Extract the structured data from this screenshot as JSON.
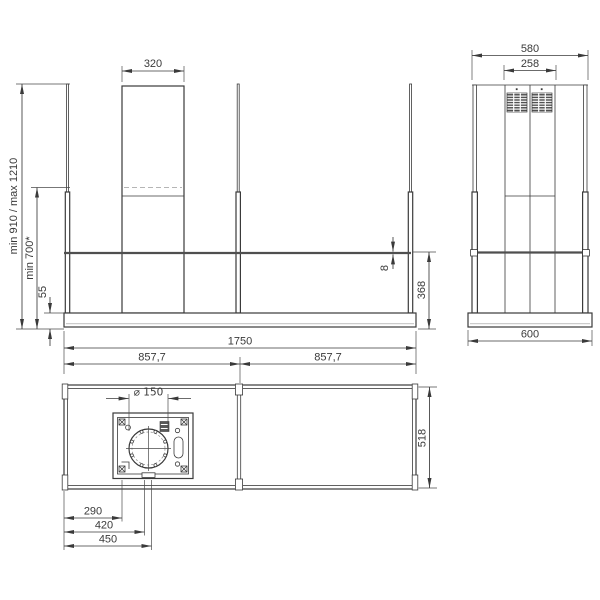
{
  "drawing": {
    "title": "island-hood-installation-drawing",
    "views": {
      "front": {
        "label": "front-elevation",
        "dims": {
          "chimney_width": "320",
          "height_range": "min 910 / max 1210",
          "min_height": "min 700*",
          "canopy_height": "55",
          "glass_thickness": "8",
          "glass_to_bottom": "368"
        }
      },
      "side": {
        "label": "side-elevation",
        "dims": {
          "total_width": "580",
          "chimney_width": "258",
          "canopy_depth": "600"
        }
      },
      "plan": {
        "label": "bottom-plan-view",
        "dims": {
          "total_width": "1750",
          "left_span": "857,7",
          "right_span": "857,7",
          "duct_diameter": "⌀ 150",
          "canopy_depth": "518",
          "offset_box": "290",
          "offset_duct_center": "420",
          "offset_outlet": "450"
        }
      }
    },
    "colors": {
      "line": "#3a3a3a",
      "glass": "#4f4f4f",
      "background": "#ffffff"
    }
  }
}
